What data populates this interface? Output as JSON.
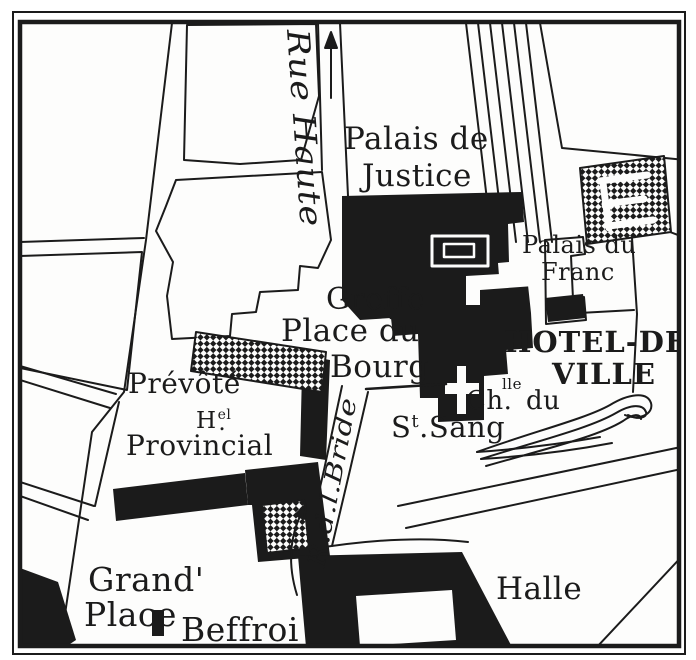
{
  "map": {
    "type": "vintage-engraved-city-map",
    "colors": {
      "ink": "#1b1b1b",
      "paper": "#fdfdfc"
    },
    "labels": {
      "rue_haute": "Rue Haute",
      "palais_de_justice_1": "Palais de",
      "palais_de_justice_2": "Justice",
      "palais_du_franc_1": "Palais du",
      "palais_du_franc_2": "Franc",
      "greffe": "Greffe",
      "place_du": "Place du",
      "bourg": "Bourg",
      "hotel_de": "HOTEL-DE",
      "ville": "VILLE",
      "chapelle_abbr": "Ch.",
      "chapelle_sup": "lle",
      "chapelle_du": "du",
      "st_abbr_s": "S",
      "st_abbr_sup": "t",
      "st_rest": ".Sang",
      "prevote": "Prévôté",
      "hotel_h": "H",
      "hotel_sup": "el",
      "hotel_dot": ".",
      "provincial": "Provincial",
      "rue_bride": "R.d.l.Bride",
      "grand": "Grand'",
      "place": "Place",
      "beffroi": "Beffroi",
      "halle": "Halle"
    },
    "icons": {
      "north_arrow": "up-arrow-in-rue-haute",
      "direction_arrow": "curved-up-arrow-near-bride-street",
      "church_cross": "white-cross-st-sang-chapel",
      "beffroi_marker": "small-black-belfry-block"
    }
  }
}
